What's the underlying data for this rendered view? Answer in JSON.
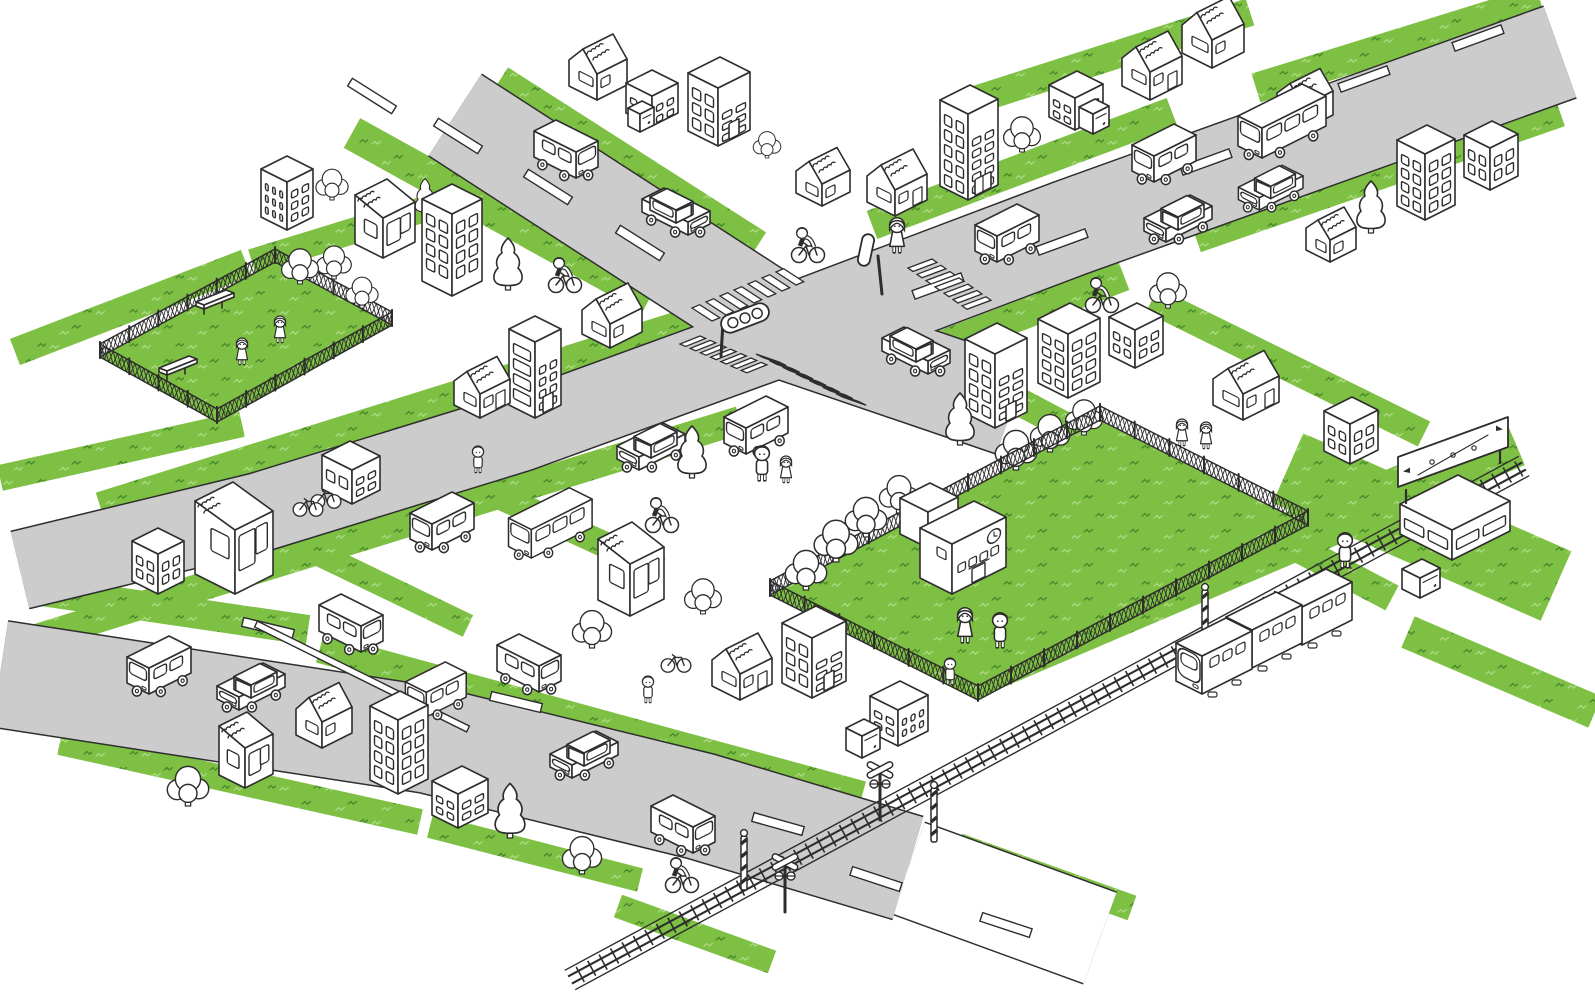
{
  "title": "isometric-town-illustration",
  "canvas": {
    "width": 1595,
    "height": 1001
  },
  "palette": {
    "ink": "#2d2d2d",
    "road_fill": "#cbcccb",
    "road_edge": "#2e2e2e",
    "grass": "#7ec043",
    "grass_fleck_dark": "#4a8c2c",
    "grass_fleck_light": "#a8d87e",
    "white": "#ffffff"
  },
  "legend": {
    "grass_bands": "[x1,y1,x2,y2,width] green verge strips",
    "roads": "gray streets as thick strokes, pts = polyline",
    "blocks": "[x,y,a,b,h,winRightCols,winRightRows,winLeftCols,winLeftRows,door] white multi-window buildings",
    "gables": "[x,y,a,b,h,roofH,door] houses with scribbled gable roofs",
    "kiosks": "[x,y,a,b,h] slant-roof shop houses",
    "annexes": "[x,y,a,b,h] tiny vending boxes",
    "clouds": "[x,y,scale] round leafy trees",
    "conifers": "[x,y,scale] pointy trees",
    "vehicles": "[type,x,y,facing,scale]",
    "people": "[x,y,kind] kinds: m man, w woman, g girl, b boy"
  },
  "grass_bands": [
    [
      352,
      133,
      650,
      298,
      34
    ],
    [
      500,
      80,
      758,
      245,
      30
    ],
    [
      872,
      225,
      1172,
      112,
      30
    ],
    [
      1256,
      88,
      1540,
      0,
      30
    ],
    [
      852,
      380,
      1124,
      276,
      30
    ],
    [
      1196,
      238,
      1560,
      112,
      30
    ],
    [
      100,
      506,
      695,
      320,
      28
    ],
    [
      30,
      640,
      740,
      420,
      28
    ],
    [
      15,
      352,
      246,
      263,
      28
    ],
    [
      252,
      262,
      428,
      208,
      26
    ],
    [
      0,
      478,
      242,
      424,
      26
    ],
    [
      35,
      590,
      308,
      630,
      30
    ],
    [
      320,
      648,
      862,
      796,
      30
    ],
    [
      60,
      742,
      420,
      822,
      26
    ],
    [
      430,
      826,
      640,
      880,
      24
    ],
    [
      1016,
      400,
      1392,
      598,
      28
    ],
    [
      985,
      668,
      1515,
      442,
      50
    ],
    [
      1288,
      468,
      1556,
      586,
      76
    ],
    [
      1408,
      632,
      1595,
      712,
      34
    ],
    [
      958,
      846,
      1132,
      908,
      26
    ],
    [
      618,
      906,
      772,
      962,
      24
    ],
    [
      1152,
      300,
      1424,
      434,
      28
    ],
    [
      975,
      100,
      1250,
      12,
      28
    ],
    [
      442,
      470,
      660,
      570,
      26
    ],
    [
      252,
      522,
      468,
      626,
      24
    ]
  ],
  "roads": [
    {
      "name": "road-below-rail",
      "pts": [
        [
          908,
          868
        ],
        [
          1100,
          938
        ]
      ],
      "w": 96,
      "white": true
    },
    {
      "name": "road-north",
      "pts": [
        [
          455,
          115
        ],
        [
          792,
          333
        ]
      ],
      "w": 96
    },
    {
      "name": "road-east",
      "pts": [
        [
          792,
          333
        ],
        [
          1070,
          228
        ],
        [
          1560,
          52
        ]
      ],
      "w": 96
    },
    {
      "name": "road-southeast",
      "pts": [
        [
          792,
          333
        ],
        [
          1012,
          408
        ]
      ],
      "w": 96
    },
    {
      "name": "road-west",
      "pts": [
        [
          792,
          333
        ],
        [
          520,
          432
        ],
        [
          260,
          512
        ],
        [
          20,
          570
        ]
      ],
      "w": 78
    },
    {
      "name": "road-south",
      "pts": [
        [
          0,
          674
        ],
        [
          430,
          740
        ],
        [
          700,
          806
        ],
        [
          908,
          868
        ]
      ],
      "w": 106
    }
  ],
  "lane_dashes": [
    [
      372,
      96,
      1,
      0.63
    ],
    [
      458,
      136,
      1,
      0.63
    ],
    [
      548,
      187,
      1,
      0.63
    ],
    [
      640,
      243,
      1,
      0.63
    ],
    [
      938,
      286,
      1,
      -0.365
    ],
    [
      1062,
      242,
      1,
      -0.365
    ],
    [
      1206,
      162,
      1,
      -0.365
    ],
    [
      1364,
      79,
      1,
      -0.365
    ],
    [
      1478,
      38,
      1,
      -0.365
    ],
    [
      268,
      628,
      1,
      0.24
    ],
    [
      516,
      702,
      1,
      0.24
    ],
    [
      778,
      824,
      1,
      0.28
    ],
    [
      876,
      879,
      1,
      0.33
    ],
    [
      1006,
      925,
      1,
      0.33
    ]
  ],
  "lane_line": {
    "x1": 256,
    "y1": 624,
    "x2": 468,
    "y2": 729,
    "w": 6.5
  },
  "crosswalks": [
    {
      "start": [
        692,
        308
      ],
      "step": [
        14.0,
        -6.0
      ],
      "n": 7,
      "bar": [
        20,
        13
      ]
    },
    {
      "start": [
        908,
        268
      ],
      "step": [
        9.0,
        6.3
      ],
      "n": 7,
      "bar": [
        24,
        -9
      ]
    },
    {
      "start": [
        756,
        354
      ],
      "step": [
        13.3,
        6.6
      ],
      "n": 7,
      "bar": [
        23,
        8
      ]
    },
    {
      "start": [
        700,
        336
      ],
      "step": [
        10.2,
        4.4
      ],
      "n": 7,
      "bar": [
        -20,
        8
      ]
    }
  ],
  "railway": {
    "from": [
      1524,
      466
    ],
    "to": [
      570,
      980
    ],
    "half": 11,
    "tie_step": 13
  },
  "parks": [
    {
      "name": "small-park",
      "pts": [
        [
          100,
          357
        ],
        [
          275,
          262
        ],
        [
          392,
          325
        ],
        [
          217,
          422
        ]
      ],
      "fence_h": 13
    },
    {
      "name": "school-yard",
      "pts": [
        [
          770,
          595
        ],
        [
          1100,
          420
        ],
        [
          1308,
          525
        ],
        [
          978,
          700
        ]
      ],
      "fence_h": 14
    }
  ],
  "benches": [
    [
      212,
      306
    ],
    [
      175,
      372
    ]
  ],
  "school": {
    "x": 952,
    "y": 594,
    "a": 54,
    "b": 32,
    "h": 50,
    "wing": [
      928,
      548,
      30,
      28,
      36
    ]
  },
  "billboard": {
    "x": 1398,
    "y": 487,
    "len": 110,
    "drop": 40,
    "th": 30
  },
  "blocks": [
    [
      287,
      230,
      26,
      26,
      48,
      2,
      3,
      3,
      3,
      0
    ],
    [
      452,
      296,
      30,
      30,
      82,
      2,
      4,
      2,
      4,
      0
    ],
    [
      652,
      126,
      26,
      26,
      30,
      2,
      2,
      2,
      2,
      0
    ],
    [
      718,
      146,
      32,
      30,
      58,
      2,
      3,
      2,
      3,
      1
    ],
    [
      968,
      200,
      30,
      28,
      86,
      2,
      5,
      2,
      5,
      2
    ],
    [
      1075,
      130,
      28,
      26,
      32,
      2,
      2,
      2,
      2,
      0
    ],
    [
      1425,
      220,
      30,
      28,
      66,
      2,
      4,
      2,
      4,
      0
    ],
    [
      1490,
      190,
      28,
      26,
      42,
      2,
      2,
      2,
      2,
      0
    ],
    [
      995,
      428,
      32,
      30,
      74,
      2,
      4,
      2,
      4,
      1
    ],
    [
      1068,
      398,
      32,
      30,
      64,
      2,
      4,
      2,
      4,
      0
    ],
    [
      1135,
      368,
      28,
      26,
      38,
      2,
      2,
      2,
      2,
      0
    ],
    [
      1350,
      464,
      28,
      26,
      40,
      2,
      2,
      2,
      2,
      0
    ],
    [
      352,
      504,
      28,
      30,
      34,
      2,
      2,
      2,
      1,
      0
    ],
    [
      158,
      594,
      26,
      26,
      40,
      2,
      2,
      2,
      2,
      0
    ],
    [
      535,
      418,
      26,
      26,
      76,
      2,
      4,
      1,
      4,
      1
    ],
    [
      812,
      698,
      34,
      30,
      60,
      2,
      3,
      2,
      3,
      1
    ],
    [
      898,
      746,
      30,
      28,
      36,
      3,
      2,
      2,
      2,
      0
    ],
    [
      398,
      794,
      30,
      28,
      74,
      2,
      4,
      2,
      4,
      0
    ],
    [
      458,
      828,
      30,
      26,
      34,
      2,
      2,
      2,
      2,
      0
    ],
    [
      1452,
      560,
      58,
      52,
      30,
      2,
      1,
      2,
      1,
      0
    ]
  ],
  "gables": [
    [
      597,
      100,
      30,
      28,
      26,
      18,
      0
    ],
    [
      822,
      206,
      28,
      26,
      22,
      16,
      0
    ],
    [
      895,
      216,
      32,
      28,
      26,
      18,
      1
    ],
    [
      1150,
      100,
      32,
      28,
      28,
      18,
      1
    ],
    [
      1212,
      68,
      32,
      30,
      28,
      20,
      0
    ],
    [
      1303,
      130,
      30,
      26,
      24,
      16,
      0
    ],
    [
      1330,
      262,
      26,
      24,
      22,
      14,
      0
    ],
    [
      1243,
      420,
      36,
      30,
      26,
      18,
      1
    ],
    [
      480,
      418,
      30,
      26,
      24,
      16,
      1
    ],
    [
      610,
      348,
      32,
      28,
      24,
      18,
      0
    ],
    [
      740,
      700,
      32,
      28,
      26,
      18,
      1
    ],
    [
      322,
      748,
      30,
      26,
      26,
      18,
      0
    ]
  ],
  "kiosks": [
    [
      383,
      258,
      32,
      28,
      40
    ],
    [
      235,
      594,
      38,
      40,
      64
    ],
    [
      630,
      616,
      34,
      32,
      52
    ],
    [
      245,
      788,
      28,
      26,
      40
    ]
  ],
  "annexes": [
    [
      640,
      132,
      14,
      12,
      18
    ],
    [
      1093,
      134,
      16,
      14,
      20
    ],
    [
      862,
      758,
      18,
      16,
      22
    ],
    [
      1420,
      598,
      20,
      18,
      20
    ]
  ],
  "clouds": [
    [
      332,
      200,
      0.7
    ],
    [
      767,
      158,
      0.6
    ],
    [
      1022,
      152,
      0.8
    ],
    [
      1168,
      308,
      0.8
    ],
    [
      188,
      806,
      0.9
    ],
    [
      582,
      874,
      0.85
    ],
    [
      592,
      648,
      0.85
    ],
    [
      703,
      614,
      0.8
    ],
    [
      300,
      284,
      0.8
    ],
    [
      334,
      279,
      0.75
    ],
    [
      362,
      308,
      0.7
    ],
    [
      806,
      590,
      0.9
    ],
    [
      836,
      562,
      0.95
    ],
    [
      866,
      537,
      0.9
    ],
    [
      899,
      513,
      0.85
    ],
    [
      1016,
      470,
      0.9
    ],
    [
      1050,
      452,
      0.85
    ],
    [
      1084,
      435,
      0.8
    ]
  ],
  "conifers": [
    [
      508,
      290,
      1
    ],
    [
      692,
      478,
      1
    ],
    [
      960,
      445,
      1
    ],
    [
      1371,
      233,
      1
    ],
    [
      510,
      838,
      1.05
    ],
    [
      425,
      215,
      0.7
    ]
  ],
  "vehicles": [
    [
      "van",
      570,
      178,
      "se",
      1
    ],
    [
      "car",
      682,
      235,
      "se",
      1
    ],
    [
      "van",
      1003,
      262,
      "sw",
      1
    ],
    [
      "van",
      1160,
      182,
      "sw",
      1
    ],
    [
      "car",
      1172,
      242,
      "sw",
      1
    ],
    [
      "bus",
      1268,
      158,
      "sw",
      1
    ],
    [
      "car",
      1265,
      210,
      "sw",
      0.95
    ],
    [
      "car",
      922,
      374,
      "se",
      1
    ],
    [
      "van",
      752,
      454,
      "sw",
      1
    ],
    [
      "car",
      645,
      470,
      "sw",
      1
    ],
    [
      "bus",
      537,
      558,
      "sw",
      0.95
    ],
    [
      "van",
      438,
      550,
      "sw",
      1
    ],
    [
      "van",
      155,
      694,
      "sw",
      1
    ],
    [
      "car",
      245,
      710,
      "sw",
      1
    ],
    [
      "van",
      355,
      652,
      "se",
      1
    ],
    [
      "van",
      533,
      692,
      "se",
      1
    ],
    [
      "car",
      578,
      778,
      "sw",
      1
    ],
    [
      "van",
      687,
      853,
      "se",
      1
    ],
    [
      "van",
      432,
      717,
      "sw",
      0.95
    ]
  ],
  "train_cars": [
    [
      1208,
      694
    ],
    [
      1258,
      668
    ],
    [
      1308,
      645
    ]
  ],
  "people": [
    [
      897,
      252,
      "w"
    ],
    [
      478,
      472,
      "b"
    ],
    [
      762,
      480,
      "m"
    ],
    [
      786,
      482,
      "g"
    ],
    [
      1182,
      445,
      "g"
    ],
    [
      1206,
      448,
      "g"
    ],
    [
      1345,
      567,
      "m"
    ],
    [
      648,
      702,
      "b"
    ],
    [
      965,
      642,
      "w"
    ],
    [
      1000,
      647,
      "m"
    ],
    [
      950,
      684,
      "b"
    ],
    [
      242,
      364,
      "g"
    ],
    [
      280,
      342,
      "g"
    ]
  ],
  "cyclists": [
    [
      565,
      290
    ],
    [
      808,
      260
    ],
    [
      1102,
      310
    ],
    [
      250,
      562
    ],
    [
      662,
      530
    ],
    [
      682,
      890
    ]
  ],
  "bicycles": [
    [
      308,
      514
    ],
    [
      326,
      506
    ],
    [
      676,
      670
    ]
  ],
  "traffic_lights": [
    {
      "x": 745,
      "y": 318,
      "kind": "front"
    },
    {
      "x": 866,
      "y": 250,
      "kind": "side"
    }
  ],
  "crossing": {
    "crossbucks": [
      [
        880,
        770
      ],
      [
        785,
        862
      ]
    ],
    "barriers": [
      [
        744,
        836
      ],
      [
        934,
        788
      ],
      [
        1205,
        590
      ]
    ]
  }
}
